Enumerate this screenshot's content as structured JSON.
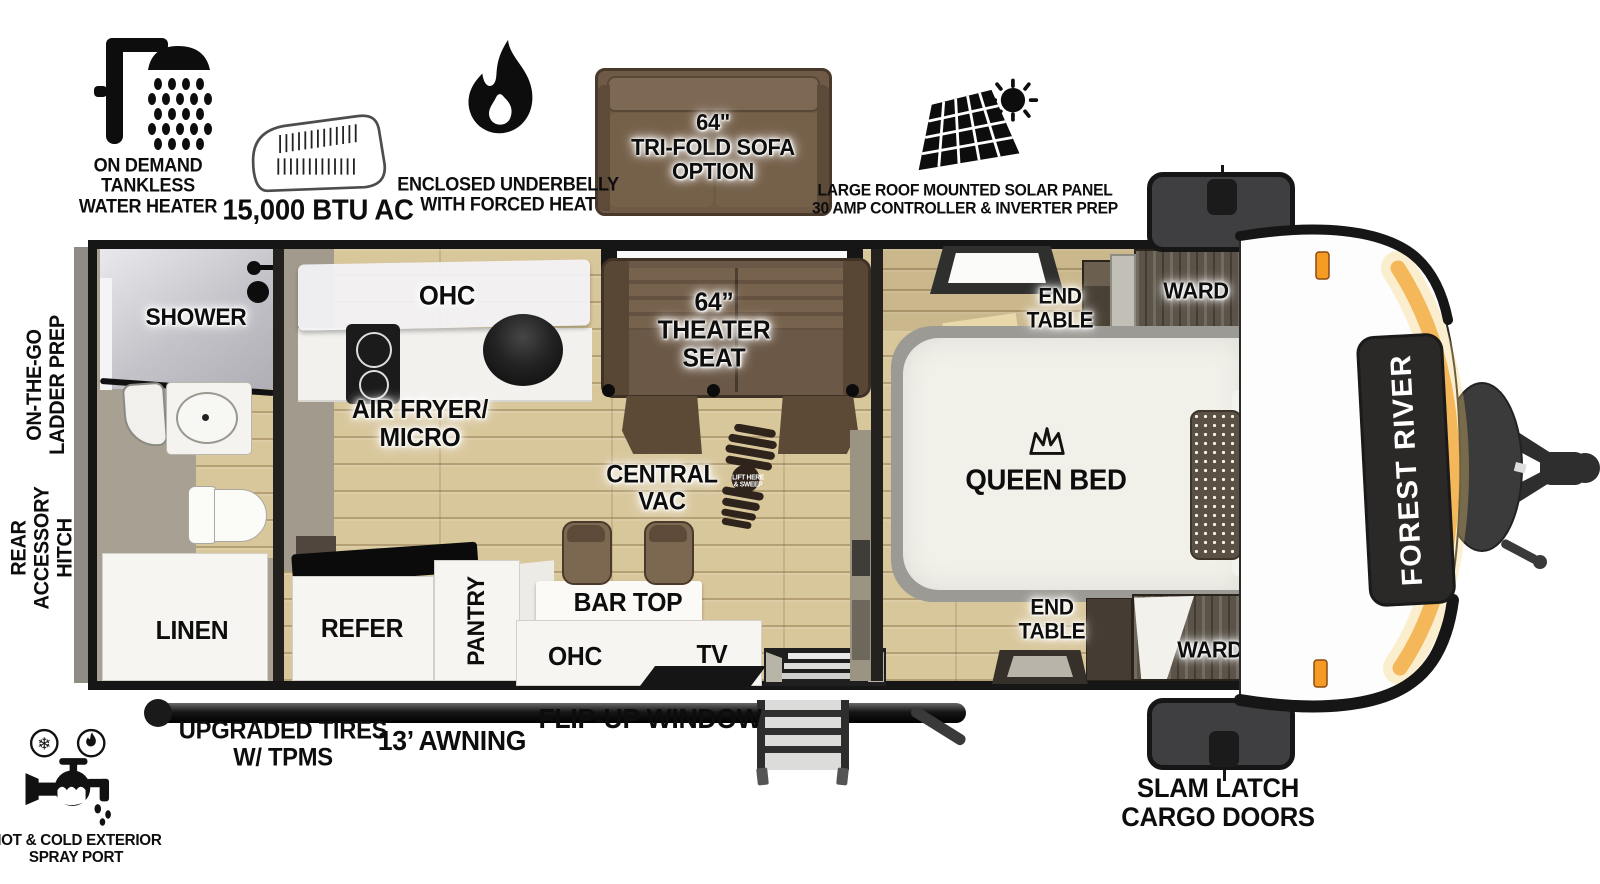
{
  "brand": {
    "name": "FOREST RIVER"
  },
  "features": {
    "water_heater": {
      "icon": "shower-icon",
      "label": "ON DEMAND\nTANKLESS\nWATER HEATER"
    },
    "ac": {
      "icon": "ac-unit-icon",
      "label": "15,000 BTU AC"
    },
    "underbelly": {
      "icon": "flame-icon",
      "label": "ENCLOSED UNDERBELLY\nWITH FORCED HEAT"
    },
    "sofa_option": {
      "icon": "sofa-image",
      "label": "64\"\nTRI-FOLD SOFA\nOPTION"
    },
    "solar": {
      "icon": "solar-panel-icon",
      "label": "LARGE ROOF MOUNTED SOLAR PANEL\n30 AMP CONTROLLER & INVERTER PREP"
    }
  },
  "exterior": {
    "ladder_prep": "ON-THE-GO\nLADDER PREP",
    "rear_hitch": "REAR\nACCESSORY\nHITCH",
    "spray_port": "HOT & COLD EXTERIOR\nSPRAY PORT",
    "tires": "UPGRADED TIRES\nW/ TPMS",
    "awning": "13’ AWNING",
    "flip_window": "FLIP-UP WINDOW",
    "cargo_doors": "SLAM LATCH\nCARGO DOORS"
  },
  "rooms": {
    "bath": {
      "shower": "SHOWER",
      "linen": "LINEN"
    },
    "kitchen": {
      "ohc": "OHC",
      "air_fryer": "AIR FRYER/\nMICRO",
      "refer": "REFER",
      "pantry": "PANTRY",
      "bar_top": "BAR TOP",
      "ohc_lower": "OHC",
      "tv": "TV"
    },
    "living": {
      "theater_seat": "64”\nTHEATER\nSEAT",
      "central_vac": "CENTRAL\nVAC",
      "boot_text": "LIFT HERE\n& SWEEP"
    },
    "bedroom": {
      "queen_bed": "QUEEN BED",
      "end_table_top": "END\nTABLE",
      "end_table_bottom": "END\nTABLE",
      "ward_top": "WARD",
      "ward_bottom": "WARD"
    }
  },
  "colors": {
    "accent_orange": "#F2A93C",
    "floor_wood": "#D8C69B",
    "seat_brown": "#6B5846",
    "marker_light": "#F59B23"
  }
}
